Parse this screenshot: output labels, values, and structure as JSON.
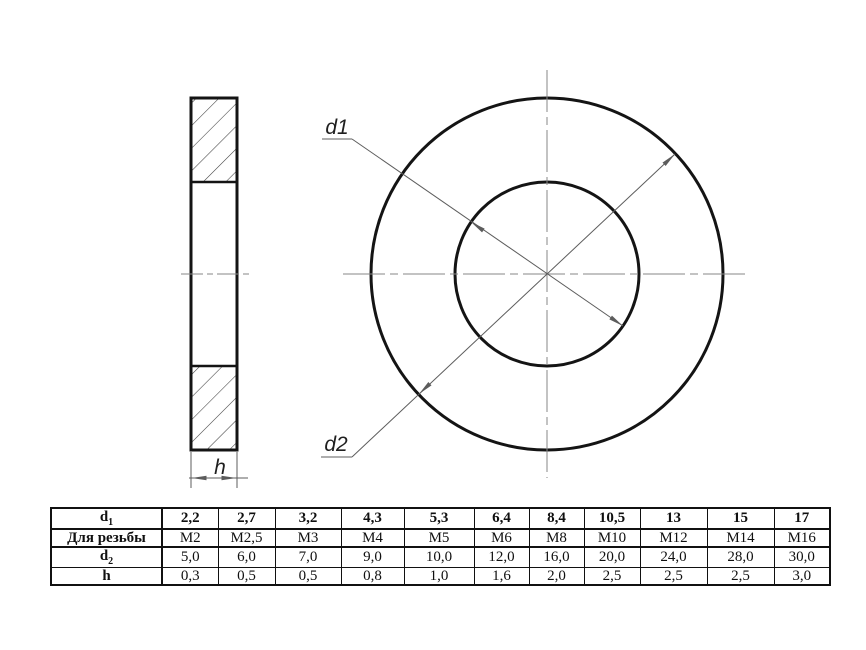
{
  "drawing": {
    "labels": {
      "d1": "d1",
      "d2": "d2",
      "h": "h"
    }
  },
  "colors": {
    "background": "#ffffff",
    "outline": "#141414",
    "dimension_line": "#5c5c5c",
    "centerline": "#878787",
    "hatch_line": "#3e3e3e",
    "label_text": "#1f1f1f",
    "table_border": "#111111",
    "table_text": "#101010"
  },
  "table": {
    "rows": [
      {
        "label_base": "d",
        "label_sub": "1",
        "bold_values": true,
        "values": [
          "2,2",
          "2,7",
          "3,2",
          "4,3",
          "5,3",
          "6,4",
          "8,4",
          "10,5",
          "13",
          "15",
          "17"
        ]
      },
      {
        "label_base": "Для резьбы",
        "label_sub": "",
        "bold_values": false,
        "values": [
          "М2",
          "М2,5",
          "М3",
          "М4",
          "М5",
          "М6",
          "М8",
          "М10",
          "М12",
          "М14",
          "М16"
        ]
      },
      {
        "label_base": "d",
        "label_sub": "2",
        "bold_values": false,
        "values": [
          "5,0",
          "6,0",
          "7,0",
          "9,0",
          "10,0",
          "12,0",
          "16,0",
          "20,0",
          "24,0",
          "28,0",
          "30,0"
        ]
      },
      {
        "label_base": "h",
        "label_sub": "",
        "bold_values": false,
        "values": [
          "0,3",
          "0,5",
          "0,5",
          "0,8",
          "1,0",
          "1,6",
          "2,0",
          "2,5",
          "2,5",
          "2,5",
          "3,0"
        ]
      }
    ]
  }
}
